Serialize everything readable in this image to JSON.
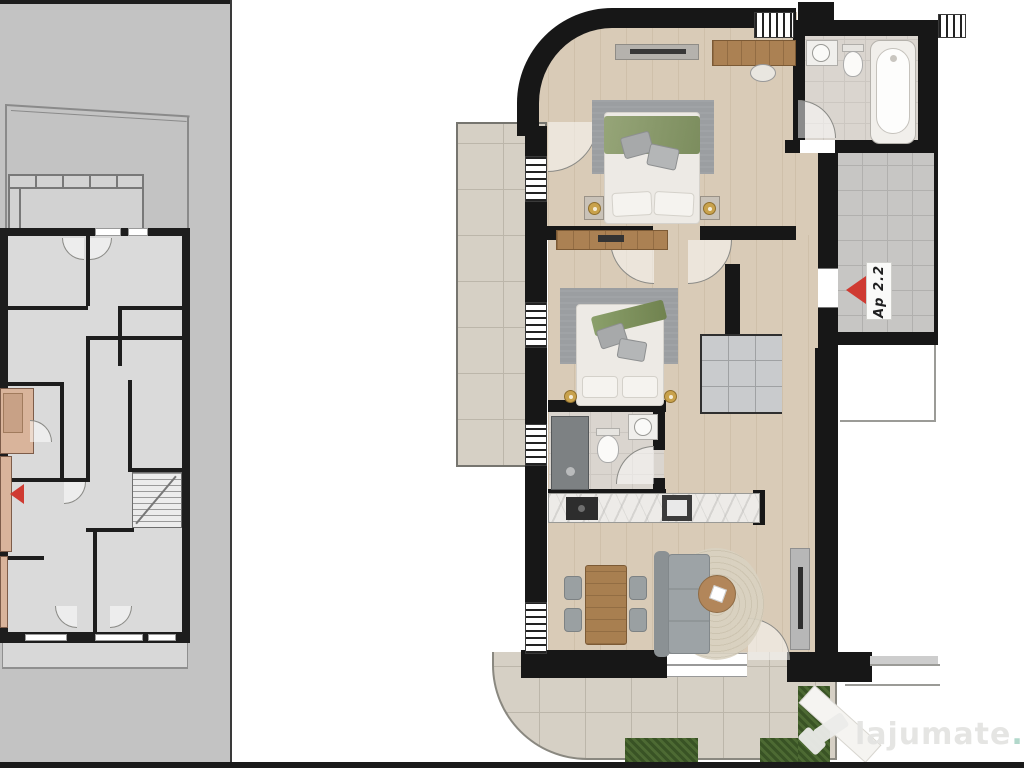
{
  "overview_panel": {
    "background": "#c3c3c3",
    "wall_color": "#1d1d1d",
    "room_fill": "#dadada",
    "highlight_fill": "#d9b49b",
    "entrance_arrow_color": "#cf3a31"
  },
  "main_plan": {
    "apartment_label": "Ap 2.2",
    "entrance_arrow_color": "#cf3a31",
    "wall_color": "#171717",
    "wood_floor_color": "#d9cbb7",
    "terrace_tile_color": "#d6d0c5",
    "hallway_tile_color": "#c7c6c4",
    "bathroom_tile_color": "#dad5cf",
    "rug_color": "#9b9ea1",
    "bed_blanket_green": "#8a9a6d",
    "furniture_wood_color": "#ab8153",
    "sofa_color": "#9aa0a3",
    "hedge_color": "#4d6a33"
  },
  "watermark": {
    "brand": "lajumate",
    "tld": ".ro",
    "brand_color": "#e4e4e2",
    "tld_color": "#aed6c9",
    "logo": "lajumate-check-logo"
  }
}
